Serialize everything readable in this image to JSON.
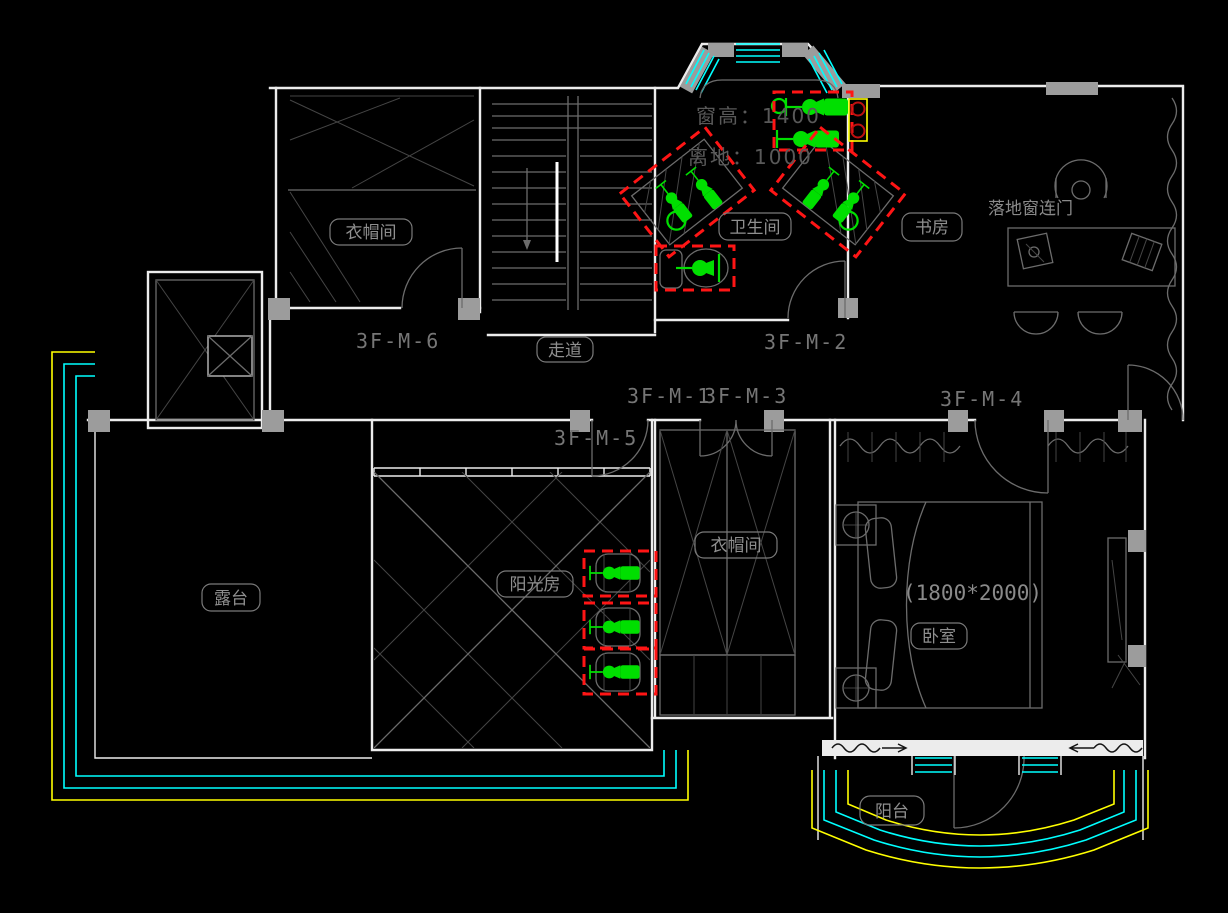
{
  "rooms": {
    "cloakroom_upper": "衣帽间",
    "bathroom": "卫生间",
    "study": "书房",
    "corridor": "走道",
    "cloakroom_lower": "衣帽间",
    "sunroom": "阳光房",
    "terrace": "露台",
    "bedroom": "卧室",
    "balcony": "阳台"
  },
  "door_tags": {
    "m1": "3F-M-1",
    "m2": "3F-M-2",
    "m3": "3F-M-3",
    "m4": "3F-M-4",
    "m5": "3F-M-5",
    "m6": "3F-M-6"
  },
  "annotations": {
    "window_height": "窗高：1400",
    "sill_height": "离地：1000",
    "bed_size": "(1800*2000)",
    "floor_window": "落地窗连门"
  },
  "highlights": {
    "red_dashed_boxes": 7,
    "green_fixtures": 10,
    "marker_circles": 2
  },
  "colors": {
    "background": "#000000",
    "wall": "#ececec",
    "furniture": "#6c6c6c",
    "label_text": "#8f8f8f",
    "fixture_green": "#00df00",
    "highlight_red": "#ff1515",
    "window_cyan": "#00ffff",
    "layer_yellow": "#ffff00",
    "column_gray": "#9c9c9c"
  }
}
